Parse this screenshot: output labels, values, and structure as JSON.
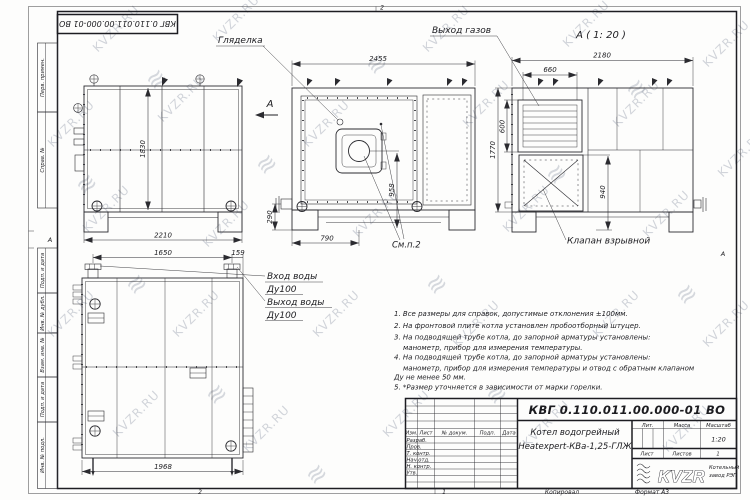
{
  "page": {
    "doc_number": "КВГ 0.110.011.00.000-01 ВО",
    "frame_marks": {
      "top_num": "2",
      "bottom_num": "2",
      "footer_num": "1",
      "zone_left": "А",
      "zone_right": "А"
    },
    "footer": {
      "kopiroval": "Копировал",
      "format": "Формат А3"
    }
  },
  "margin_fields": [
    "Перв. примен.",
    "Справ. №",
    "Подп. и дата",
    "Инв. № дубл.",
    "Взам. инв. №",
    "Подп. и дата",
    "Инв. № подл."
  ],
  "views": {
    "side": {
      "section_label": "А",
      "dims": {
        "height": "1830",
        "width": "2210"
      }
    },
    "front": {
      "label_sight": "Гляделка",
      "label_see_item": "См.п.2",
      "dims": {
        "width": "2455",
        "burner_axis_height": "958",
        "burner_axis_offset": "790",
        "pipe_axis_height": "290"
      }
    },
    "rear": {
      "view_title": "А ( 1: 20 )",
      "label_gas_outlet": "Выход газов",
      "label_explosion_valve": "Клапан взрывной",
      "dims": {
        "width": "2180",
        "height": "1770",
        "gas_outlet_width": "660",
        "gas_outlet_height": "600",
        "valve_axis_height": "940"
      }
    },
    "plan": {
      "label_water_in": "Вход воды",
      "label_water_in_dn": "Ду100",
      "label_water_out": "Выход воды",
      "label_water_out_dn": "Ду100",
      "dims": {
        "nozzle_span": "1650",
        "nozzle_to_edge": "159",
        "length": "1968"
      }
    }
  },
  "notes": {
    "lines": [
      "1. Все размеры для справок, допустимые отклонения ±100мм.",
      "2. На фронтовой плите котла установлен пробоотборный штуцер.",
      "3. На подводящей трубе котла, до запорной арматуры установлены:",
      "манометр, прибор для измерения температуры.",
      "4. На подводящей трубе котла, до запорной арматуры установлены:",
      "манометр, прибор для измерения температуры и отвод с обратным клапаном",
      "Ду не менее 50 мм.",
      "5. *Размер уточняется в зависимости от марки горелки."
    ]
  },
  "title_block": {
    "product_name_line1": "Котел водогрейный",
    "product_name_line2": "Heatexpert-КВа-1,25-ГЛЖ",
    "columns": {
      "izm": "Изм.",
      "list": "Лист",
      "doc": "№ докум.",
      "podp": "Подп.",
      "data": "Дата"
    },
    "rows": [
      "Разраб.",
      "Пров.",
      "Т. контр.",
      "Нач.отд.",
      "Н. контр.",
      "Утв."
    ],
    "lit_label": "Лит.",
    "mass_label": "Масса",
    "scale_label": "Масштаб",
    "scale_value": "1:20",
    "sheet_label": "Лист",
    "sheets_label": "Листов",
    "sheets_value": "1",
    "logo_text": "KVZR",
    "company_line1": "Котельный",
    "company_line2": "завод РЭП"
  },
  "watermark": {
    "text": "KVZR.RU",
    "logo_glyph": "≋",
    "text_positions": [
      [
        90,
        45
      ],
      [
        210,
        35
      ],
      [
        420,
        45
      ],
      [
        560,
        40
      ],
      [
        700,
        60
      ],
      [
        45,
        140
      ],
      [
        155,
        115
      ],
      [
        300,
        140
      ],
      [
        460,
        120
      ],
      [
        610,
        120
      ],
      [
        715,
        170
      ],
      [
        80,
        225
      ],
      [
        200,
        240
      ],
      [
        350,
        230
      ],
      [
        500,
        225
      ],
      [
        640,
        230
      ],
      [
        45,
        330
      ],
      [
        170,
        330
      ],
      [
        310,
        330
      ],
      [
        450,
        340
      ],
      [
        590,
        330
      ],
      [
        700,
        340
      ],
      [
        110,
        430
      ],
      [
        240,
        445
      ],
      [
        380,
        430
      ],
      [
        520,
        440
      ],
      [
        660,
        445
      ]
    ],
    "logo_positions": [
      [
        140,
        75
      ],
      [
        360,
        60
      ],
      [
        620,
        85
      ],
      [
        70,
        180
      ],
      [
        250,
        160
      ],
      [
        540,
        170
      ],
      [
        120,
        280
      ],
      [
        420,
        280
      ],
      [
        670,
        290
      ],
      [
        200,
        390
      ],
      [
        480,
        390
      ],
      [
        300,
        470
      ]
    ]
  }
}
